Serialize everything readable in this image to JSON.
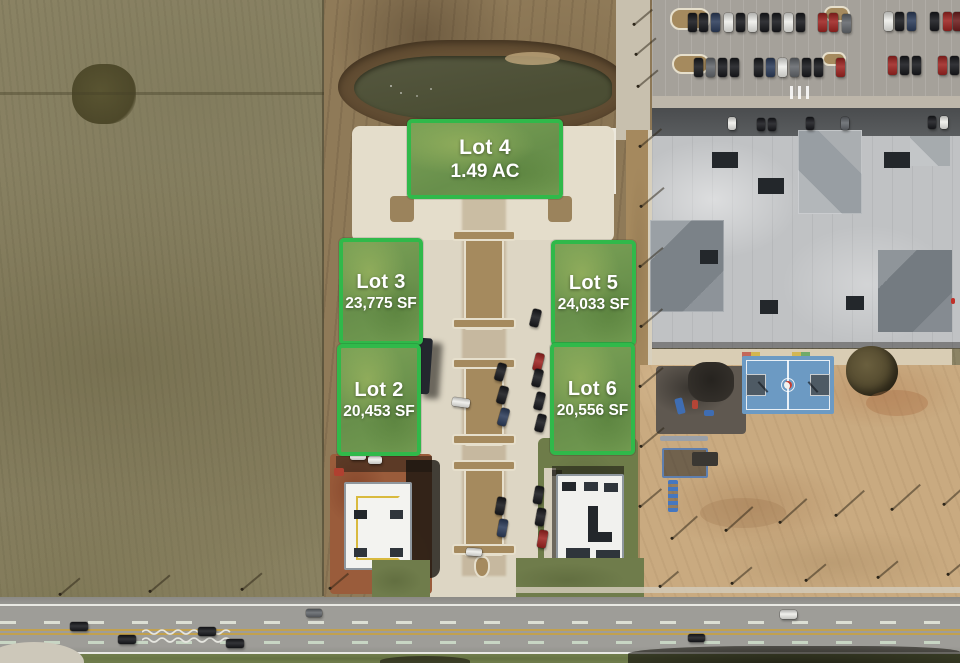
{
  "meta": {
    "title": "Aerial lot availability map"
  },
  "colors": {
    "lot_border": "#30b94a",
    "lot_label": "#ffffff"
  },
  "lots": [
    {
      "id": "lot-4",
      "name": "Lot 4",
      "area": "1.49 AC"
    },
    {
      "id": "lot-3",
      "name": "Lot 3",
      "area": "23,775 SF"
    },
    {
      "id": "lot-5",
      "name": "Lot 5",
      "area": "24,033 SF"
    },
    {
      "id": "lot-2",
      "name": "Lot 2",
      "area": "20,453 SF"
    },
    {
      "id": "lot-6",
      "name": "Lot 6",
      "area": "20,556 SF"
    }
  ],
  "vehicles": [
    [
      688,
      13,
      9,
      19,
      "k",
      0
    ],
    [
      699,
      13,
      9,
      19,
      "k",
      0
    ],
    [
      711,
      13,
      9,
      19,
      "n",
      0
    ],
    [
      724,
      13,
      9,
      19,
      "w",
      0
    ],
    [
      736,
      13,
      9,
      19,
      "k",
      0
    ],
    [
      748,
      13,
      9,
      19,
      "w",
      0
    ],
    [
      760,
      13,
      9,
      19,
      "k",
      0
    ],
    [
      772,
      13,
      9,
      19,
      "k",
      0
    ],
    [
      784,
      13,
      9,
      19,
      "w",
      0
    ],
    [
      796,
      13,
      9,
      19,
      "k",
      0
    ],
    [
      818,
      13,
      9,
      19,
      "r",
      0
    ],
    [
      829,
      13,
      9,
      19,
      "r",
      0
    ],
    [
      842,
      14,
      9,
      19,
      "g",
      0
    ],
    [
      884,
      12,
      9,
      19,
      "w",
      0
    ],
    [
      895,
      12,
      9,
      19,
      "k",
      0
    ],
    [
      907,
      12,
      9,
      19,
      "n",
      0
    ],
    [
      930,
      12,
      9,
      19,
      "k",
      0
    ],
    [
      943,
      12,
      9,
      19,
      "r",
      0
    ],
    [
      953,
      12,
      9,
      19,
      "dr",
      0
    ],
    [
      694,
      58,
      9,
      19,
      "k",
      0
    ],
    [
      706,
      58,
      9,
      19,
      "g",
      0
    ],
    [
      718,
      58,
      9,
      19,
      "k",
      0
    ],
    [
      730,
      58,
      9,
      19,
      "k",
      0
    ],
    [
      754,
      58,
      9,
      19,
      "k",
      0
    ],
    [
      766,
      58,
      9,
      19,
      "n",
      0
    ],
    [
      778,
      58,
      9,
      19,
      "w",
      0
    ],
    [
      790,
      58,
      9,
      19,
      "g",
      0
    ],
    [
      802,
      58,
      9,
      19,
      "k",
      0
    ],
    [
      814,
      58,
      9,
      19,
      "k",
      0
    ],
    [
      836,
      58,
      9,
      19,
      "r",
      0
    ],
    [
      888,
      56,
      9,
      19,
      "r",
      0
    ],
    [
      900,
      56,
      9,
      19,
      "k",
      0
    ],
    [
      912,
      56,
      9,
      19,
      "k",
      0
    ],
    [
      938,
      56,
      9,
      19,
      "r",
      0
    ],
    [
      950,
      56,
      9,
      19,
      "k",
      0
    ],
    [
      728,
      117,
      8,
      13,
      "w",
      0
    ],
    [
      757,
      118,
      8,
      13,
      "k",
      0
    ],
    [
      768,
      118,
      8,
      13,
      "k",
      0
    ],
    [
      806,
      117,
      8,
      13,
      "k",
      0
    ],
    [
      841,
      117,
      8,
      13,
      "g",
      0
    ],
    [
      928,
      116,
      8,
      13,
      "k",
      0
    ],
    [
      940,
      116,
      8,
      13,
      "w",
      0
    ],
    [
      531,
      309,
      9,
      18,
      "k",
      14
    ],
    [
      534,
      353,
      9,
      18,
      "r",
      14
    ],
    [
      496,
      363,
      9,
      18,
      "k",
      16
    ],
    [
      498,
      386,
      9,
      18,
      "k",
      16
    ],
    [
      499,
      408,
      9,
      18,
      "n",
      16
    ],
    [
      533,
      369,
      9,
      18,
      "k",
      14
    ],
    [
      535,
      392,
      9,
      18,
      "k",
      14
    ],
    [
      536,
      414,
      9,
      18,
      "k",
      14
    ],
    [
      452,
      398,
      18,
      9,
      "w",
      8
    ],
    [
      496,
      497,
      9,
      18,
      "k",
      10
    ],
    [
      498,
      519,
      9,
      18,
      "n",
      10
    ],
    [
      534,
      486,
      9,
      18,
      "k",
      10
    ],
    [
      536,
      508,
      9,
      18,
      "k",
      10
    ],
    [
      538,
      530,
      9,
      18,
      "r",
      10
    ],
    [
      466,
      548,
      16,
      8,
      "w",
      4
    ],
    [
      350,
      452,
      16,
      8,
      "w",
      0
    ],
    [
      368,
      456,
      14,
      8,
      "w",
      0
    ],
    [
      70,
      622,
      18,
      9,
      "k",
      0
    ],
    [
      118,
      635,
      18,
      9,
      "k",
      0
    ],
    [
      198,
      627,
      18,
      9,
      "k",
      0
    ],
    [
      226,
      639,
      18,
      9,
      "k",
      0
    ],
    [
      306,
      609,
      16,
      8,
      "g",
      0
    ],
    [
      688,
      634,
      17,
      8,
      "k",
      0
    ],
    [
      780,
      610,
      17,
      9,
      "w",
      0
    ]
  ],
  "pole_shadows": [
    [
      634,
      24,
      24,
      -40
    ],
    [
      636,
      54,
      26,
      -40
    ],
    [
      638,
      86,
      26,
      -40
    ],
    [
      640,
      146,
      28,
      -40
    ],
    [
      641,
      206,
      30,
      -40
    ],
    [
      640,
      266,
      30,
      -40
    ],
    [
      641,
      326,
      28,
      -40
    ],
    [
      640,
      386,
      30,
      -40
    ],
    [
      641,
      446,
      30,
      -40
    ],
    [
      640,
      506,
      28,
      -40
    ],
    [
      672,
      538,
      34,
      -42
    ],
    [
      726,
      530,
      36,
      -42
    ],
    [
      780,
      522,
      36,
      -42
    ],
    [
      836,
      515,
      38,
      -42
    ],
    [
      892,
      509,
      38,
      -42
    ],
    [
      944,
      504,
      30,
      -42
    ],
    [
      660,
      586,
      24,
      -40
    ],
    [
      732,
      583,
      26,
      -40
    ],
    [
      806,
      580,
      26,
      -40
    ],
    [
      878,
      577,
      26,
      -40
    ],
    [
      948,
      574,
      22,
      -40
    ],
    [
      60,
      594,
      26,
      -40
    ],
    [
      150,
      591,
      26,
      -40
    ],
    [
      242,
      589,
      26,
      -40
    ],
    [
      330,
      588,
      24,
      -40
    ]
  ]
}
